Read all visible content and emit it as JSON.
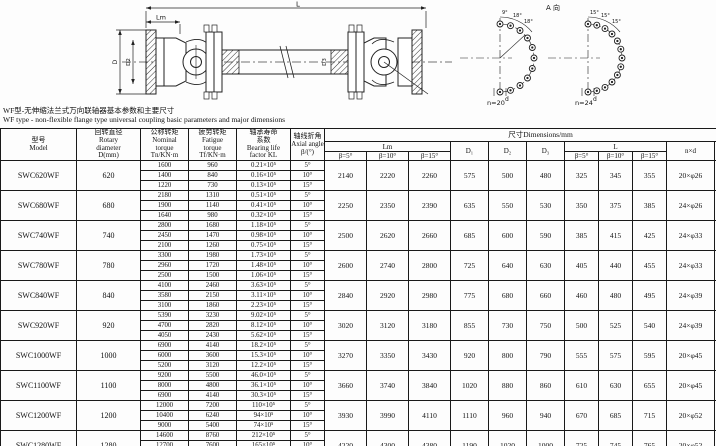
{
  "drawing": {
    "dim_L": "L",
    "dim_Lm": "Lm",
    "dim_D": "D",
    "dim_D2": "D2",
    "dim_D3": "D3",
    "view_label": "A 向",
    "n20_label": "n=20",
    "n24_label": "n=24",
    "d_label_1": "d",
    "d_label_2": "d",
    "n20_angles": [
      "9°",
      "18°",
      "18°"
    ],
    "n24_angles": [
      "15°",
      "15°",
      "15°"
    ]
  },
  "captions": {
    "zh": "WF型-无伸缩法兰式万向联轴器基本参数和主要尺寸",
    "en": "WF type - non-flexible flange type universal coupling basic parameters and major dimensions"
  },
  "table": {
    "header": {
      "model": [
        "型号",
        "Model"
      ],
      "rotary": [
        "回转直径",
        "Rotary",
        "diameter",
        "D(mm)"
      ],
      "nominal": [
        "公称转矩",
        "Nominal",
        "torque",
        "Tn/KN·m"
      ],
      "fatigue": [
        "疲劳转矩",
        "Fatigue",
        "torque",
        "Tf/KN·m"
      ],
      "bearing": [
        "轴承寿命",
        "系数",
        "Bearing life",
        "factor  KL"
      ],
      "axial": [
        "轴线折角",
        "Axial angle",
        "β/(°)"
      ],
      "dims": "尺寸Dimensions/mm",
      "lm": "Lm",
      "d1": "D₁",
      "d2": "D₂",
      "d3": "D₃",
      "l": "L",
      "nxd": "n×d",
      "k": "k",
      "betas": [
        "β=5°",
        "β=10°",
        "β=15°"
      ]
    },
    "rows": [
      {
        "model": "SWC620WF",
        "diameter": "620",
        "sub": [
          [
            "1600",
            "960",
            "0.21×10⁵",
            "5°"
          ],
          [
            "1400",
            "840",
            "0.16×10⁵",
            "10°"
          ],
          [
            "1220",
            "730",
            "0.13×10⁵",
            "15°"
          ]
        ],
        "lm": [
          "2140",
          "2220",
          "2260"
        ],
        "d": [
          "575",
          "500",
          "480"
        ],
        "l": [
          "325",
          "345",
          "355"
        ],
        "nxd": "20×φ26",
        "k": "70"
      },
      {
        "model": "SWC680WF",
        "diameter": "680",
        "sub": [
          [
            "2180",
            "1310",
            "0.51×10⁵",
            "5°"
          ],
          [
            "1900",
            "1140",
            "0.41×10⁵",
            "10°"
          ],
          [
            "1640",
            "980",
            "0.32×10⁵",
            "15°"
          ]
        ],
        "lm": [
          "2250",
          "2350",
          "2390"
        ],
        "d": [
          "635",
          "550",
          "530"
        ],
        "l": [
          "350",
          "375",
          "385"
        ],
        "nxd": "24×φ26",
        "k": "70"
      },
      {
        "model": "SWC740WF",
        "diameter": "740",
        "sub": [
          [
            "2800",
            "1680",
            "1.18×10⁵",
            "5°"
          ],
          [
            "2450",
            "1470",
            "0.98×10⁵",
            "10°"
          ],
          [
            "2100",
            "1260",
            "0.75×10⁵",
            "15°"
          ]
        ],
        "lm": [
          "2500",
          "2620",
          "2660"
        ],
        "d": [
          "685",
          "600",
          "590"
        ],
        "l": [
          "385",
          "415",
          "425"
        ],
        "nxd": "24×φ33",
        "k": "80"
      },
      {
        "model": "SWC780WF",
        "diameter": "780",
        "sub": [
          [
            "3300",
            "1980",
            "1.73×10⁵",
            "5°"
          ],
          [
            "2960",
            "1720",
            "1.48×10⁵",
            "10°"
          ],
          [
            "2500",
            "1500",
            "1.06×10⁵",
            "15°"
          ]
        ],
        "lm": [
          "2600",
          "2740",
          "2800"
        ],
        "d": [
          "725",
          "640",
          "630"
        ],
        "l": [
          "405",
          "440",
          "455"
        ],
        "nxd": "24×φ33",
        "k": "90"
      },
      {
        "model": "SWC840WF",
        "diameter": "840",
        "sub": [
          [
            "4100",
            "2460",
            "3.63×10⁵",
            "5°"
          ],
          [
            "3580",
            "2150",
            "3.11×10⁵",
            "10°"
          ],
          [
            "3100",
            "1860",
            "2.23×10⁵",
            "15°"
          ]
        ],
        "lm": [
          "2840",
          "2920",
          "2980"
        ],
        "d": [
          "775",
          "680",
          "660"
        ],
        "l": [
          "460",
          "480",
          "495"
        ],
        "nxd": "24×φ39",
        "k": "100"
      },
      {
        "model": "SWC920WF",
        "diameter": "920",
        "sub": [
          [
            "5390",
            "3230",
            "9.02×10⁵",
            "5°"
          ],
          [
            "4700",
            "2820",
            "8.12×10⁵",
            "10°"
          ],
          [
            "4050",
            "2430",
            "5.62×10⁵",
            "15°"
          ]
        ],
        "lm": [
          "3020",
          "3120",
          "3180"
        ],
        "d": [
          "855",
          "730",
          "750"
        ],
        "l": [
          "500",
          "525",
          "540"
        ],
        "nxd": "24×φ39",
        "k": "110"
      },
      {
        "model": "SWC1000WF",
        "diameter": "1000",
        "sub": [
          [
            "6900",
            "4140",
            "18.2×10⁵",
            "5°"
          ],
          [
            "6000",
            "3600",
            "15.3×10⁵",
            "10°"
          ],
          [
            "5200",
            "3120",
            "12.2×10⁵",
            "15°"
          ]
        ],
        "lm": [
          "3270",
          "3350",
          "3430"
        ],
        "d": [
          "920",
          "800",
          "790"
        ],
        "l": [
          "555",
          "575",
          "595"
        ],
        "nxd": "20×φ45",
        "k": "125"
      },
      {
        "model": "SWC1100WF",
        "diameter": "1100",
        "sub": [
          [
            "9200",
            "5500",
            "46.0×10⁵",
            "5°"
          ],
          [
            "8000",
            "4800",
            "36.1×10⁵",
            "10°"
          ],
          [
            "6900",
            "4140",
            "30.3×10⁵",
            "15°"
          ]
        ],
        "lm": [
          "3660",
          "3740",
          "3840"
        ],
        "d": [
          "1020",
          "880",
          "860"
        ],
        "l": [
          "610",
          "630",
          "655"
        ],
        "nxd": "20×φ45",
        "k": "135"
      },
      {
        "model": "SWC1200WF",
        "diameter": "1200",
        "sub": [
          [
            "12000",
            "7200",
            "110×10⁵",
            "5°"
          ],
          [
            "10400",
            "6240",
            "94×10⁵",
            "10°"
          ],
          [
            "9000",
            "5400",
            "74×10⁵",
            "15°"
          ]
        ],
        "lm": [
          "3930",
          "3990",
          "4110"
        ],
        "d": [
          "1110",
          "960",
          "940"
        ],
        "l": [
          "670",
          "685",
          "715"
        ],
        "nxd": "20×φ52",
        "k": "150"
      },
      {
        "model": "SWC1280WF",
        "diameter": "1280",
        "sub": [
          [
            "14600",
            "8760",
            "212×10⁵",
            "5°"
          ],
          [
            "12700",
            "7600",
            "165×10⁵",
            "10°"
          ],
          [
            "11000",
            "6600",
            "138×10⁵",
            "15°"
          ]
        ],
        "lm": [
          "4220",
          "4300",
          "4380"
        ],
        "d": [
          "1190",
          "1020",
          "1000"
        ],
        "l": [
          "725",
          "745",
          "765"
        ],
        "nxd": "20×φ52",
        "k": "160"
      }
    ]
  }
}
